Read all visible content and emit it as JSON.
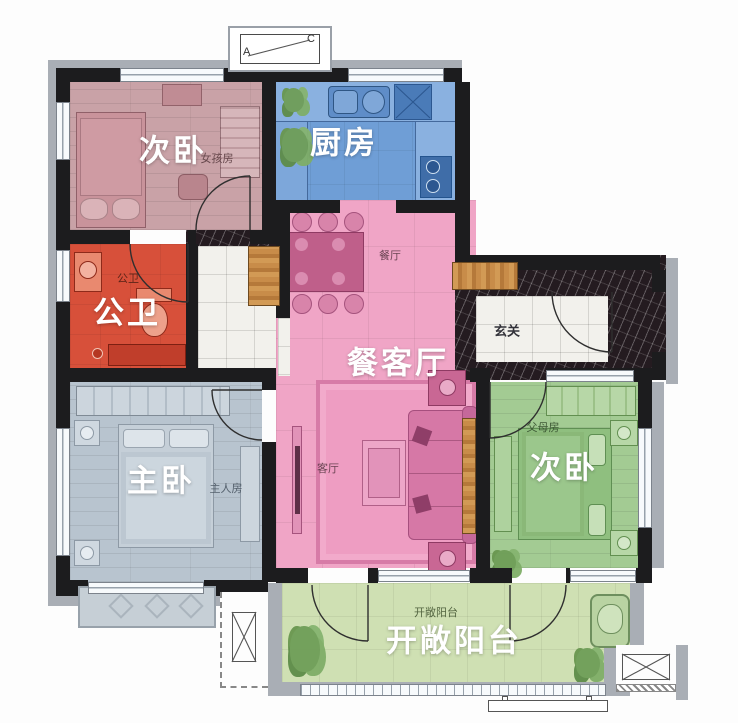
{
  "rooms": {
    "bedroom_tl": {
      "name": "次卧",
      "tag": "女孩房"
    },
    "kitchen": {
      "name": "厨房"
    },
    "bathroom": {
      "name": "公卫",
      "tag": "公卫"
    },
    "dining_living": {
      "name": "餐客厅",
      "tag_dining": "餐厅",
      "tag_living": "客厅"
    },
    "entry": {
      "name": "玄关"
    },
    "master": {
      "name": "主卧",
      "tag": "主人房"
    },
    "bedroom_r": {
      "name": "次卧",
      "tag": "父母房"
    },
    "balcony": {
      "name": "开敞阳台",
      "tag": "开敞阳台"
    }
  },
  "ac_unit": {
    "a": "A",
    "c": "C"
  },
  "colors": {
    "bedroom_tl": "#c9a2a7",
    "kitchen": "#6f9ed6",
    "bathroom": "#d7503a",
    "dining_living": "#f0a5c6",
    "master": "#b8c4cf",
    "bedroom_r": "#a3cb93",
    "balcony": "#cfe0b3",
    "wall": "#1c1c1e",
    "trim": "#a9aeb5",
    "marble": "#241b20",
    "tile": "#f2f1ec",
    "wood": "#c08440"
  }
}
